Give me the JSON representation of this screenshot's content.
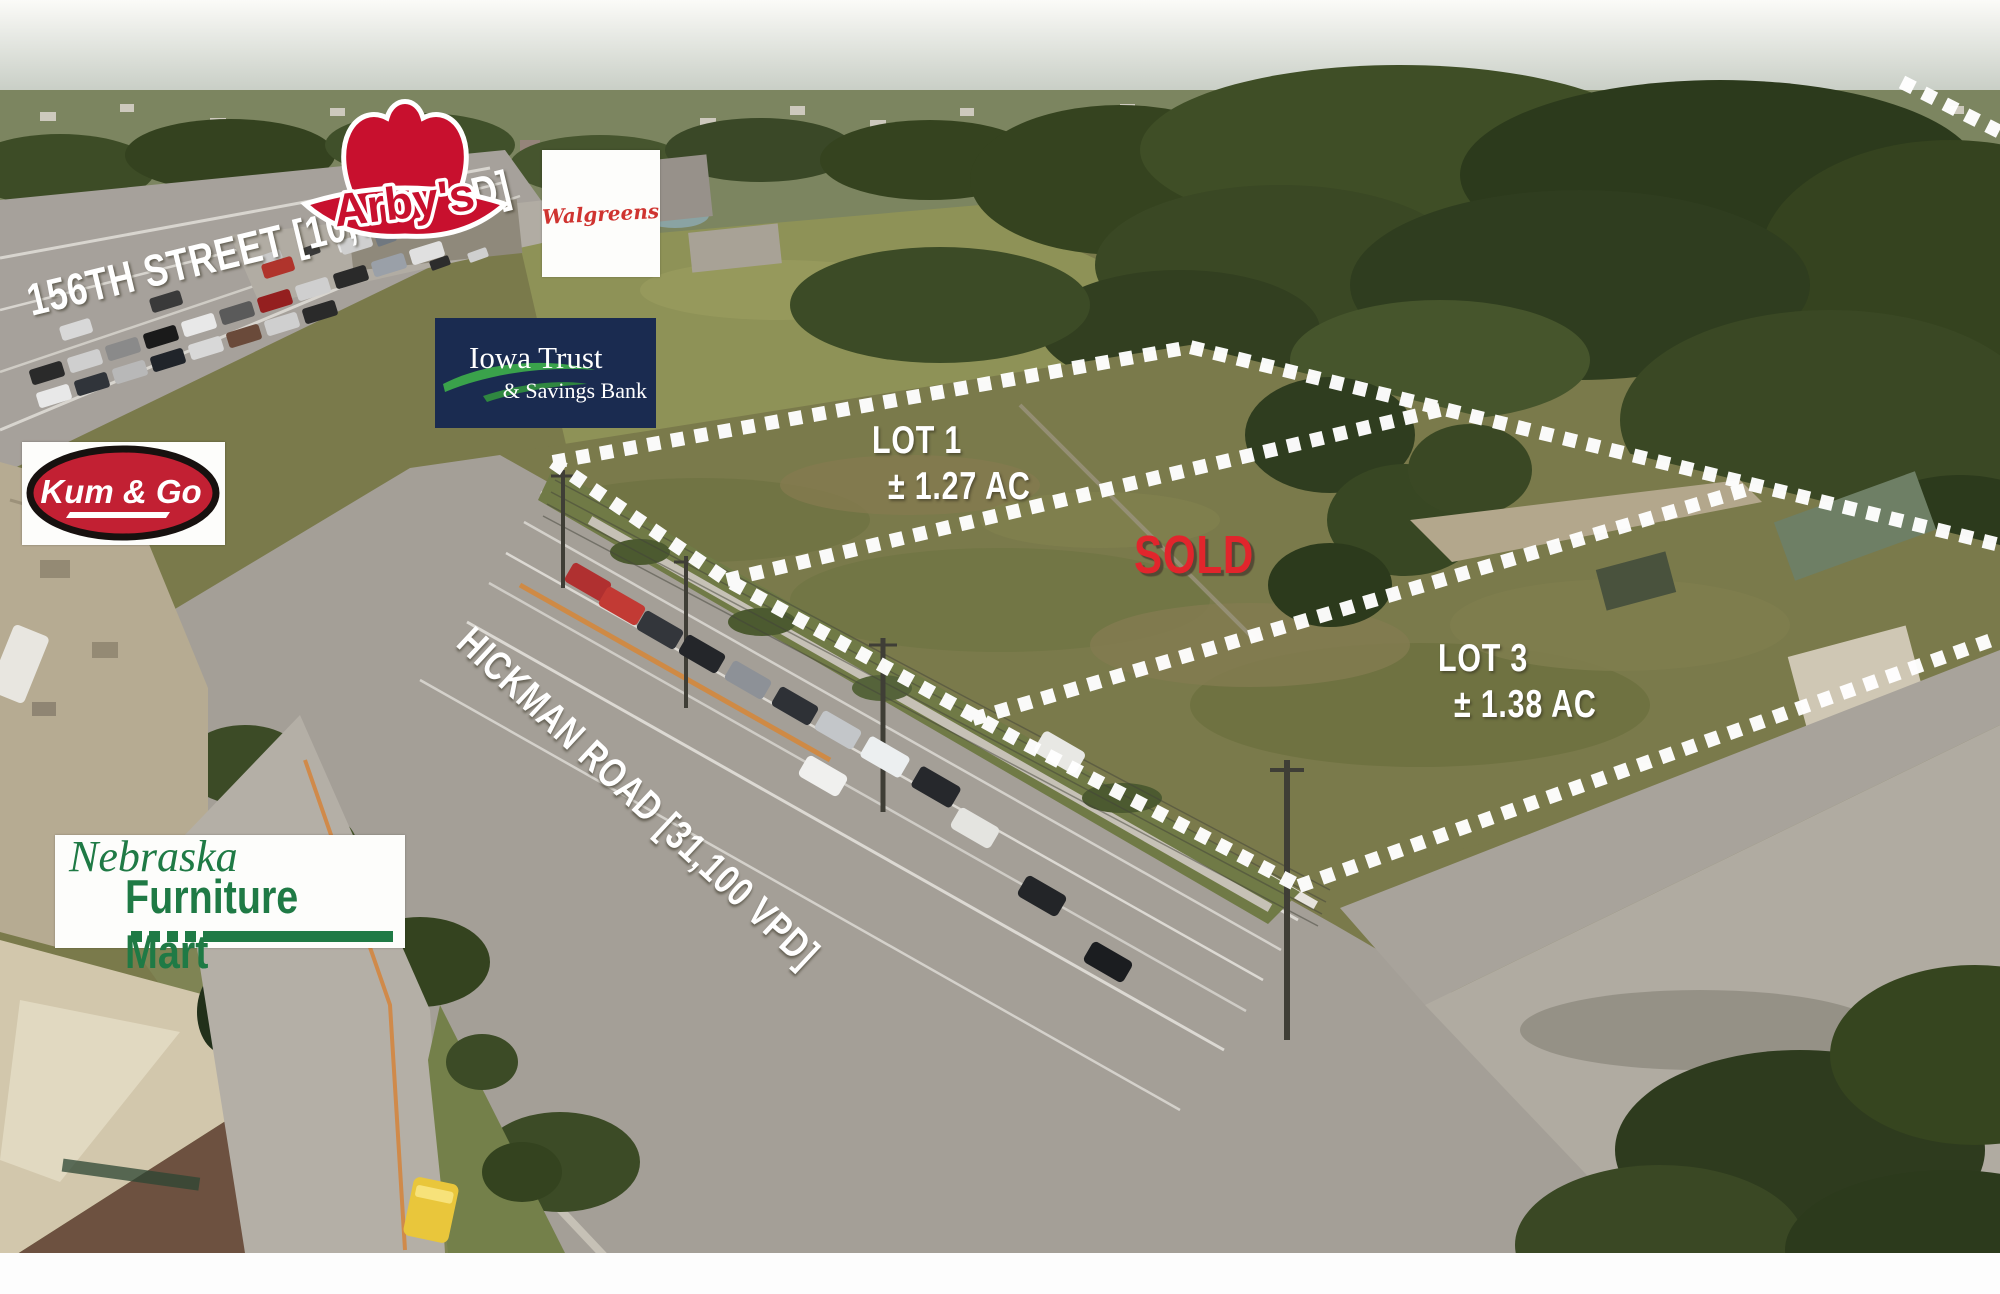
{
  "title": "Commercial lots aerial marketing photo - Hickman Road corridor",
  "streets": {
    "s156": {
      "label": "156TH STREET [10,765 VPD]"
    },
    "hickman": {
      "label": "HICKMAN ROAD [31,100 VPD]"
    }
  },
  "lots": {
    "lot1": {
      "name": "LOT 1",
      "area": "± 1.27 AC"
    },
    "sold": {
      "label": "SOLD"
    },
    "lot3": {
      "name": "LOT 3",
      "area": "± 1.38 AC"
    }
  },
  "businesses": {
    "arbys": {
      "name": "Arby's"
    },
    "walgreens": {
      "name": "Walgreens"
    },
    "iowa_trust": {
      "line1": "Iowa Trust",
      "line2": "& Savings Bank"
    },
    "kum_go": {
      "name": "Kum & Go"
    },
    "nfm": {
      "line1": "Nebraska",
      "line2": "Furniture Mart",
      "reg": "®"
    }
  },
  "colors": {
    "label_white": "#ffffff",
    "sold_red": "#e2252c",
    "dotted_line": "#ffffff",
    "arbys_red": "#c8102e",
    "walgreens_red": "#cf3430",
    "iowa_trust_navy": "#1a2b50",
    "iowa_trust_green": "#3aa24b",
    "kum_go_red": "#c22033",
    "nfm_green": "#1f7a45"
  }
}
